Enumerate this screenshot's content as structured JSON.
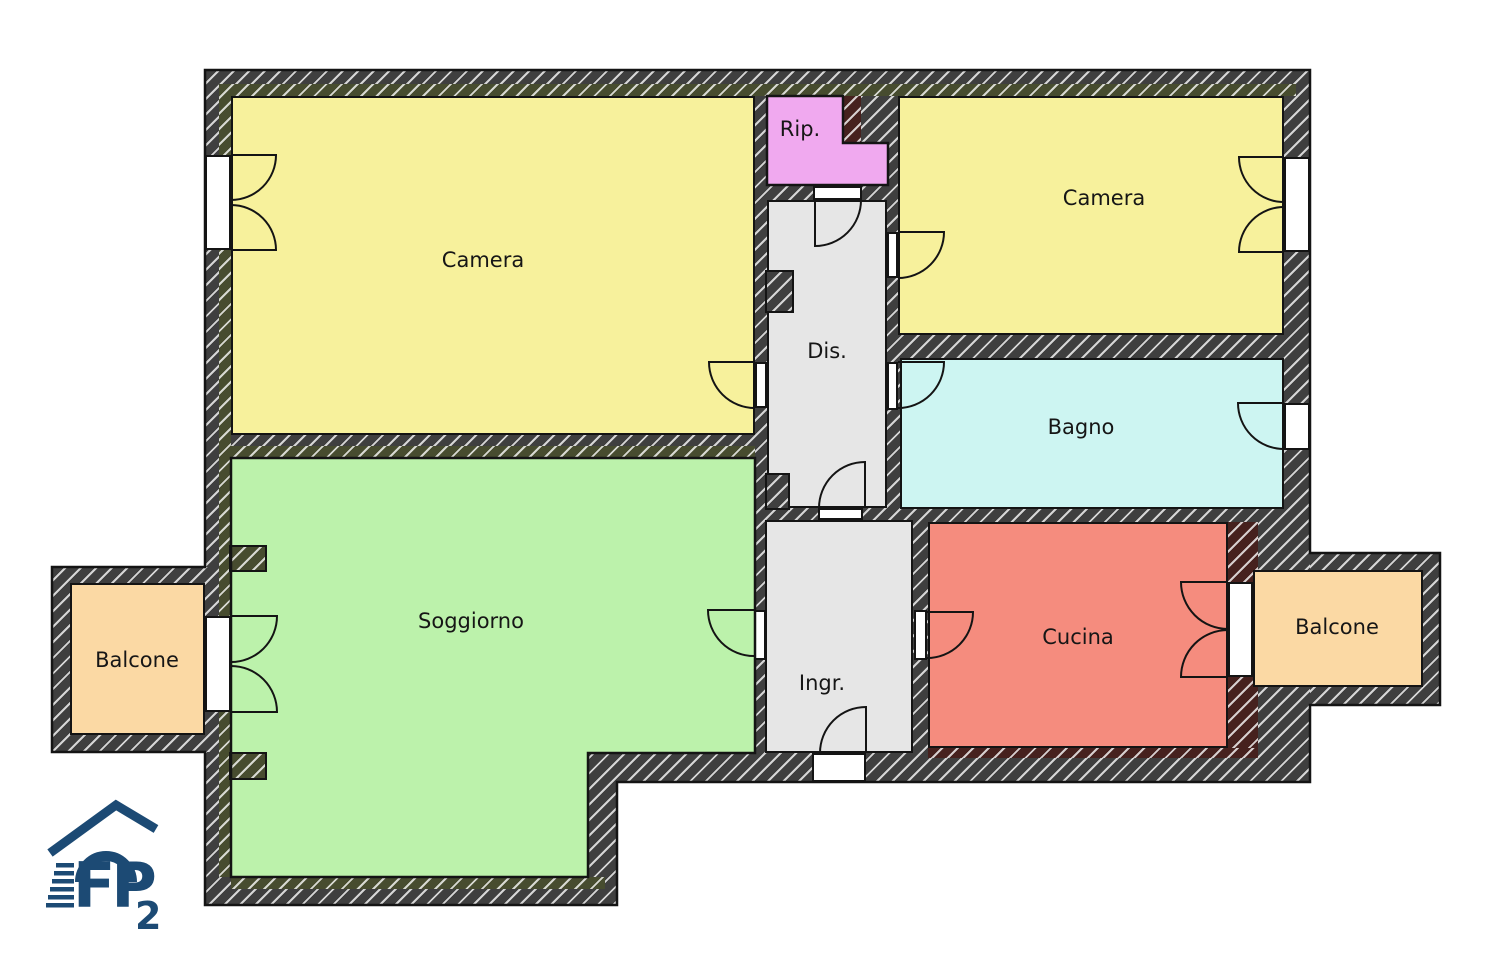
{
  "plan": {
    "rooms": [
      {
        "id": "camera_left",
        "label": "Camera"
      },
      {
        "id": "rip",
        "label": "Rip."
      },
      {
        "id": "camera_right",
        "label": "Camera"
      },
      {
        "id": "dis",
        "label": "Dis."
      },
      {
        "id": "bagno",
        "label": "Bagno"
      },
      {
        "id": "soggiorno",
        "label": "Soggiorno"
      },
      {
        "id": "ingr",
        "label": "Ingr."
      },
      {
        "id": "cucina",
        "label": "Cucina"
      },
      {
        "id": "balcone_left",
        "label": "Balcone"
      },
      {
        "id": "balcone_right",
        "label": "Balcone"
      }
    ],
    "colors": {
      "camera": "#F7F19C",
      "soggiorno": "#BCF2AB",
      "rip": "#F0A9EF",
      "dis": "#E6E6E6",
      "bagno": "#CDF5F2",
      "cucina": "#F58C7E",
      "balcone": "#FBD9A4",
      "wall": "#3F3F3F",
      "wall_existing": "#474C2F",
      "wall_new": "#46211E",
      "ink": "#141414",
      "logo": "#1C4A74"
    },
    "logo": {
      "letters": "FP",
      "sub": "2"
    }
  }
}
